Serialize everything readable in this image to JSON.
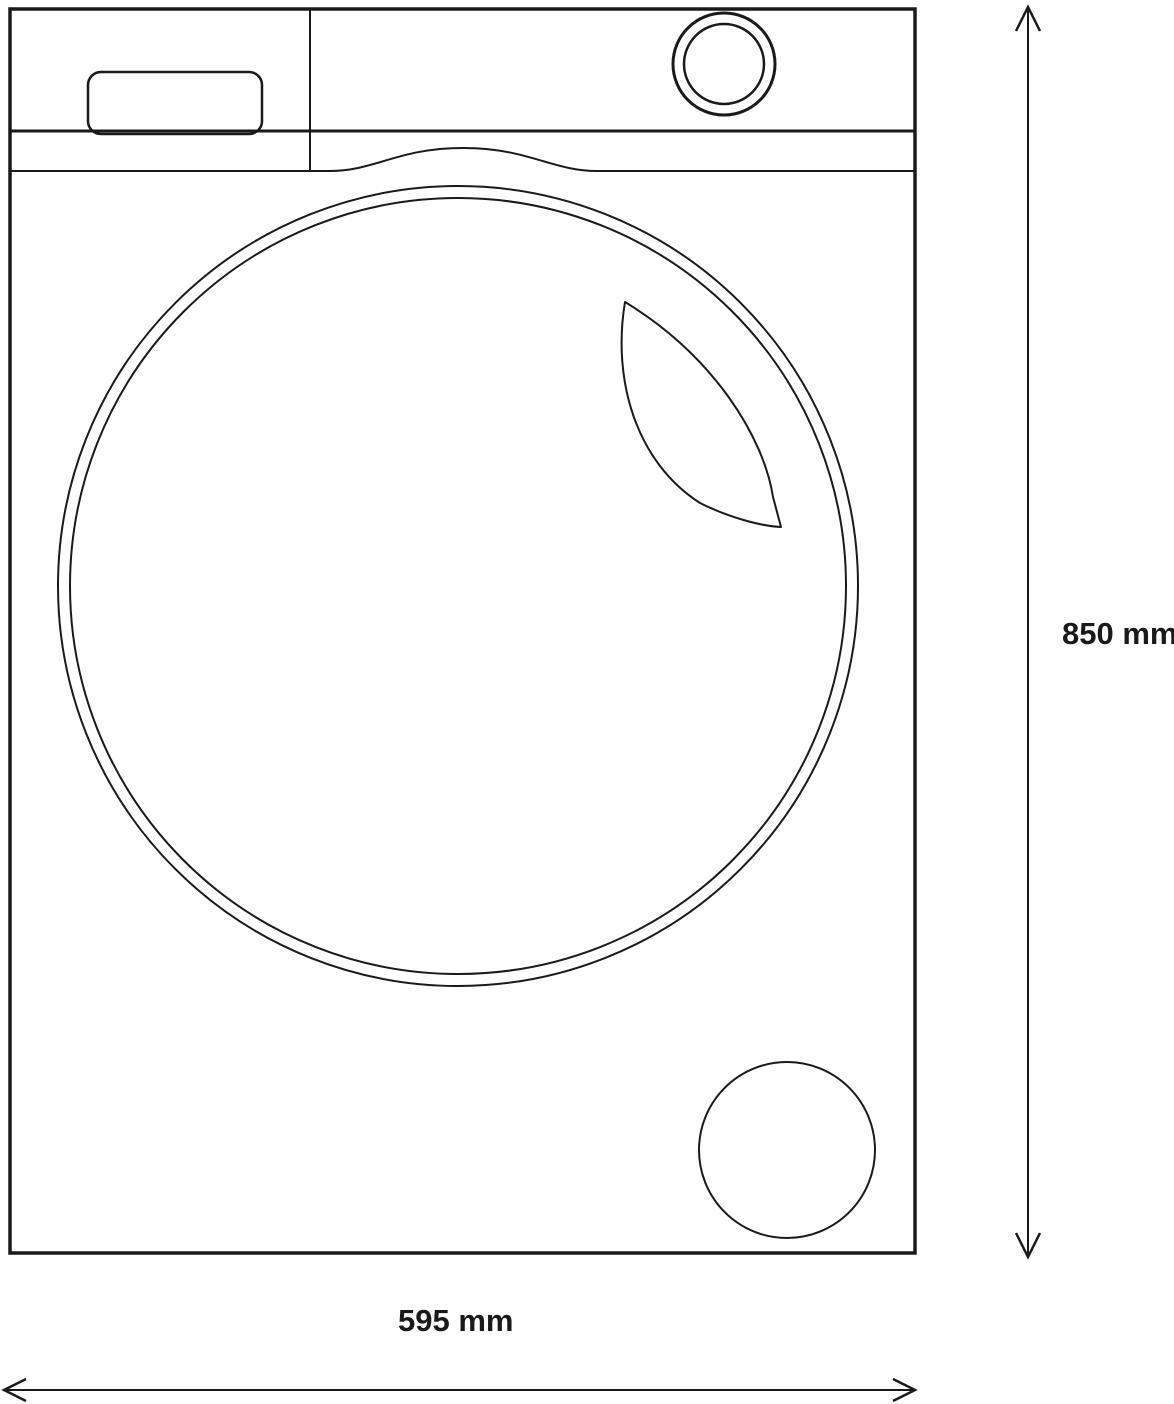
{
  "diagram": {
    "type": "technical-drawing",
    "subject": "washing-machine-front-view",
    "dimensions": {
      "height": {
        "label": "850 mm",
        "value": 850,
        "unit": "mm"
      },
      "width": {
        "label": "595 mm",
        "value": 595,
        "unit": "mm"
      }
    },
    "parts": [
      "machine-body-outline",
      "control-panel",
      "detergent-drawer",
      "control-knob",
      "door-top-trim",
      "porthole-door-outer-ring",
      "porthole-door-glass",
      "door-glass-reflection",
      "filter-access-cap",
      "height-dimension-arrow",
      "width-dimension-arrow"
    ],
    "colors": {
      "line": "#1a1a1a",
      "background": "#ffffff"
    }
  }
}
